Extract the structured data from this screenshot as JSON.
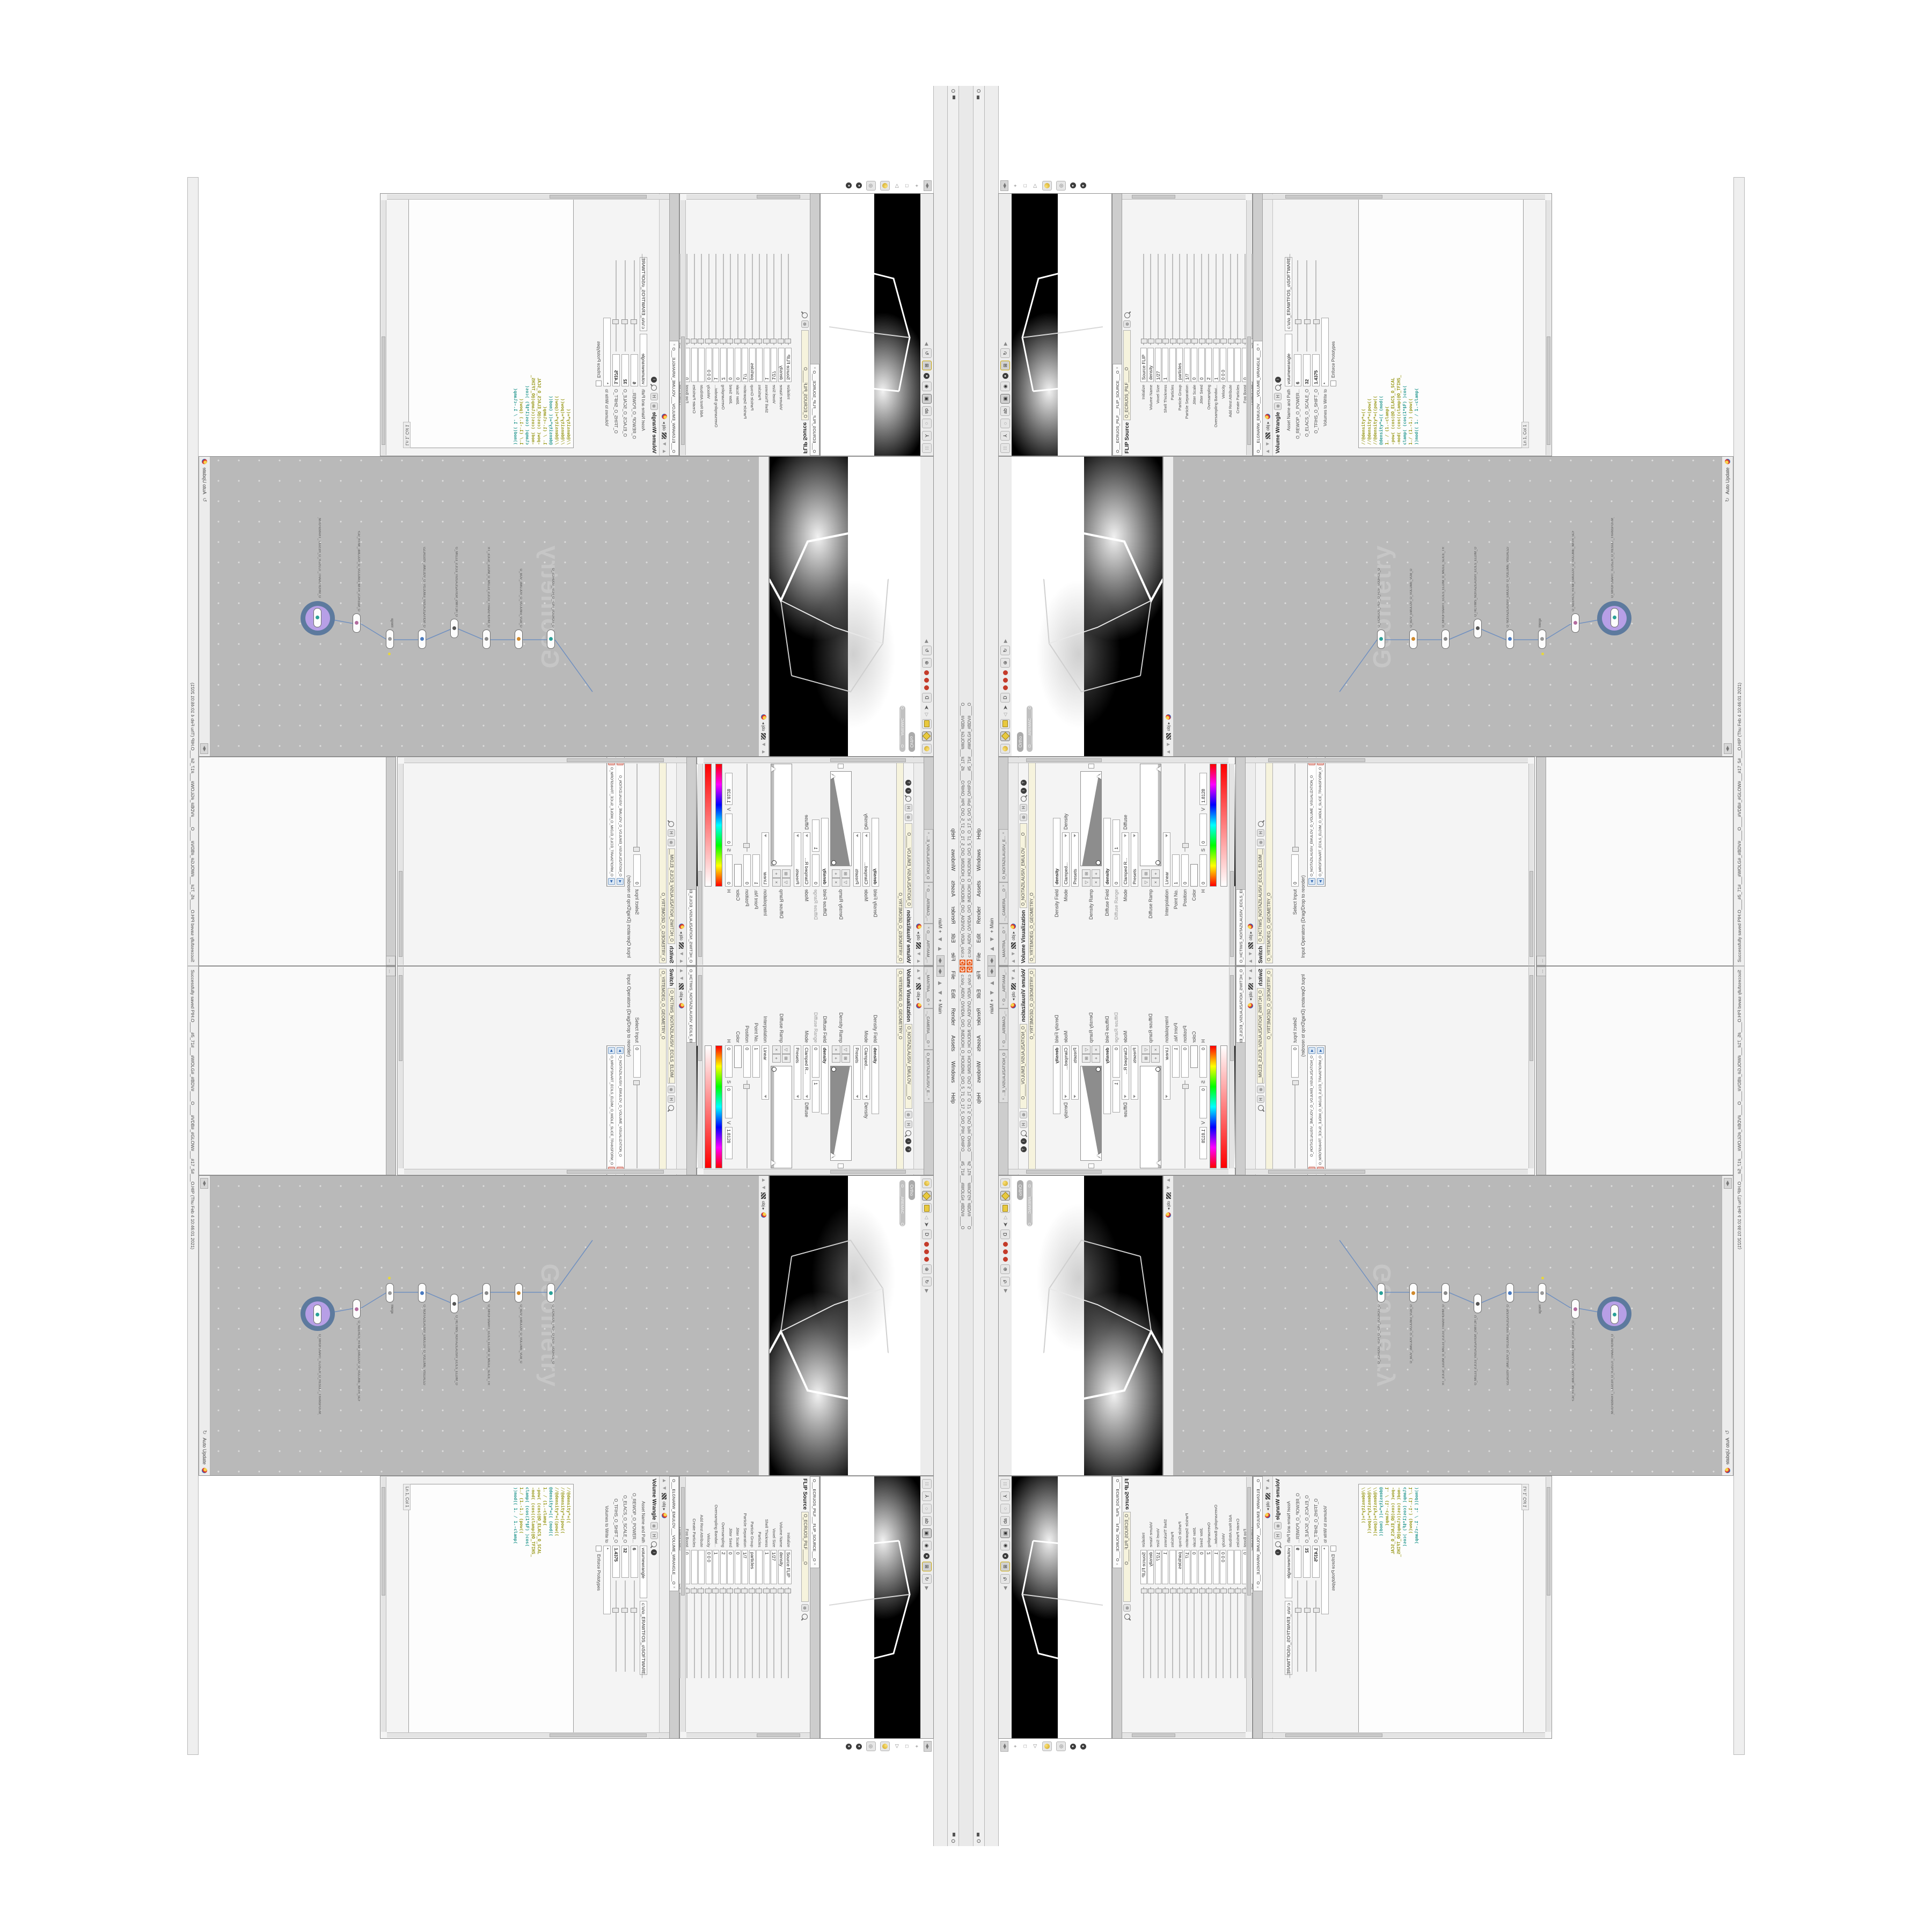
{
  "colors": {
    "accent_orange": "#e95e20",
    "network_bg": "#b9b9b9",
    "selected_node_purple": "#b79fe6",
    "selection_ring_slate": "#5d7a9e",
    "wire_blue": "#7090c0",
    "code_olive": "#99991a",
    "code_teal": "#2a9a92",
    "name_field_beige": "#f6f3dd"
  },
  "window": {
    "title_path": "c:/o/o_AIDIV_O/VIDIA_O/O_INIDUOH_O_HOUDINI_O/O_5_71_O_17_5_O/O_PIH_O/HIP.O____#5_71#___#WOLG#_#BDV#____O",
    "menu": [
      {
        "label": "File"
      },
      {
        "label": "Edit"
      },
      {
        "label": "Render"
      },
      {
        "label": "Assets"
      },
      {
        "label": "Windows"
      },
      {
        "label": "Help"
      }
    ],
    "window_button": "O",
    "desktop_label": "Main"
  },
  "p1": {
    "tabs": [
      {
        "label": "..._MANTRA___O"
      },
      {
        "label": "..._CAMERA___O"
      },
      {
        "label": "O_NOITAZILAUSIV_E..."
      }
    ],
    "breadcrumb": "obj",
    "title": "Volume Visualization",
    "name_field": "O_NOITAZILAUSIV_EMULOV_____O",
    "path_field": "O_YRTEMOEG_O_GEOMETRY_O",
    "density_field_label": "Density Field",
    "density_field_value": "density",
    "mode_label": "Mode",
    "mode_value": "Clamped...",
    "mode_suffix": "Density",
    "presets_label": "Presets",
    "density_ramp_label": "Density Ramp",
    "diffuse_field_label": "Diffuse Field",
    "diffuse_field_value": "density",
    "diffuse_range_label": "Diffuse Range",
    "diffuse_range_v0": "0",
    "diffuse_range_v1": "1",
    "mode2_value": "Clamped R...",
    "mode2_suffix": "Diffuse",
    "diffuse_ramp_label": "Diffuse Ramp",
    "interpolation_label": "Interpolation",
    "interpolation_value": "Linear",
    "point_label": "Point No.",
    "point_value": "1",
    "position_label": "Position",
    "position_value": "0",
    "color_label": "Color",
    "hsv_h_label": "H",
    "hsv_s_label": "S",
    "hsv_v_label": "V",
    "hsv_h": "0",
    "hsv_s": "0",
    "hsv_v": "1.8128"
  },
  "p2": {
    "tab": "O_HCTIWS_NOITAZILAUSIV_ECILS_EL...",
    "title": "Switch",
    "name_field": "O_HCTIWS_NOITAZILAUSIV_ECILS_ELDIM_____O",
    "path_field": "O_YRTEMOEG_O_GEOMETRY_O",
    "select_input_label": "Select Input",
    "select_input_value": "0",
    "operators_label": "Input Operators (Drag/Drop to reorder)",
    "items": [
      {
        "name": "O_NOITAZILAUSIV_EMULOV_O_VOLUME_VISUALIZATION_O"
      },
      {
        "name": "O_MROFSNART_ECILS_ELDIM_O_MIDLE_SLICE_TRANSFORM_O"
      }
    ]
  },
  "v1": {
    "ortho_label": "Ortho",
    "cam_label": "O____AREMAC____O"
  },
  "network": {
    "breadcrumb": "obj",
    "watermark": "Geometry",
    "auto_update_label": "Auto Update",
    "nodes": [
      {
        "type": "flipsource",
        "name": "O_ECRUOS_PILF_O_FLIP_SOURCE_O"
      },
      {
        "type": "vdb",
        "name": "O_BDV_EMULOV_O_VOLUME_VDB_O"
      },
      {
        "type": "transform",
        "name": "O_MROFSNART_ECILS_ELDIM_O_MIDLE_SLICE_TRANSFORM_O"
      },
      {
        "type": "switch",
        "name": "O_HCTIWS_NOITAZILAUSIV_ECILS_ELDIM_O"
      },
      {
        "type": "visualization",
        "name": "O_NOITAZILAUSIV_EMULOV_O_VOLUME_VISUALIZATION_O"
      },
      {
        "type": "merge",
        "name": "Merge"
      },
      {
        "type": "volume",
        "name": "O_NEERCS_HTIW_EMULOV_O_VOLUME_WITH_SCREEN_O"
      },
      {
        "type": "transform-selected",
        "name": "O_MROFSNART_TLUSER_O_RESULT_TRANSFORM_O"
      }
    ]
  },
  "p4": {
    "tab": "O___ECRUOS_PILF___FLIP_SOURCE___O",
    "title": "FLIP Source",
    "name_field": "O_ECRUOS_PILF_____O",
    "rows": [
      {
        "label": "Initialize",
        "value": "Source FLIP"
      },
      {
        "label": "Volume Name",
        "value": "density"
      },
      {
        "label": "Voxel Size",
        "value": "1/27"
      },
      {
        "label": "Shell Thickness",
        "value": "1"
      },
      {
        "label": "Particles",
        "value": ""
      },
      {
        "label": "Particle Group",
        "value": "particles"
      },
      {
        "label": "Particle Separation",
        "value": "1/7"
      },
      {
        "label": "Jitter Scale",
        "value": "0"
      },
      {
        "label": "Jitter Seed",
        "value": "0"
      },
      {
        "label": "Oversampling",
        "value": "2"
      },
      {
        "label": "Oversampling Bandwi...",
        "value": "1"
      },
      {
        "label": "Velocity",
        "value": "0  0  0"
      },
      {
        "label": "Add Rest Attribute",
        "value": ""
      },
      {
        "label": "Create Particles",
        "value": ""
      },
      {
        "label": "Fog Boost",
        "value": "0"
      },
      {
        "label": "Output Fog",
        "value": ""
      }
    ]
  },
  "p5": {
    "tab": "O___ELGNARW_EMULOV___VOLUME_WRANGLE___O",
    "title": "Volume Wrangle",
    "asset_label": "Asset Name and Path",
    "asset_name": "volumewrangle",
    "asset_path": "c:\\o\\o_ERAWTFOS_o\\SOFTWARE...",
    "sliders": [
      {
        "label": "O_REWOP_O_POWER...",
        "value": "6"
      },
      {
        "label": "O_ELACS_O_SCALE_O",
        "value": "32"
      },
      {
        "label": "O_TFIHS_O_SHIFT_O",
        "value": "1.4375"
      }
    ],
    "volumes_label": "Volumes to Write to",
    "volumes_value": "*",
    "enforce_label": "Enforce Prototypes",
    "code": [
      {
        "text": "//@density*=(("
      },
      {
        "text": "//@density*=(pow(("
      },
      {
        "text": "//@density*=((pow(("
      },
      {
        "text": "@density*=(( (mod(("
      },
      {
        "text": "1. / (1.-clamp("
      },
      {
        "text": "-pow( (cos(@O_ELACS_O_SCAL"
      },
      {
        "text": "-mod( (cos((clamp(@O_TFIHS_"
      },
      {
        "text": "clamp( (cos(1*$F) )cos("
      },
      {
        "text": "1./ (1.-1.) (pow(("
      },
      {
        "text": "))mod(( 1. / 1.-clamp("
      }
    ],
    "editor_status": "Ln 1, Col 1"
  },
  "status": {
    "message": "Successfully saved PIH.O____#5_71#___#WOLG#_#BDV#____O____#VDB#_#GLOW#___#17_5#___O.HIP (Thu Feb 4 10:46:01 2021)"
  }
}
